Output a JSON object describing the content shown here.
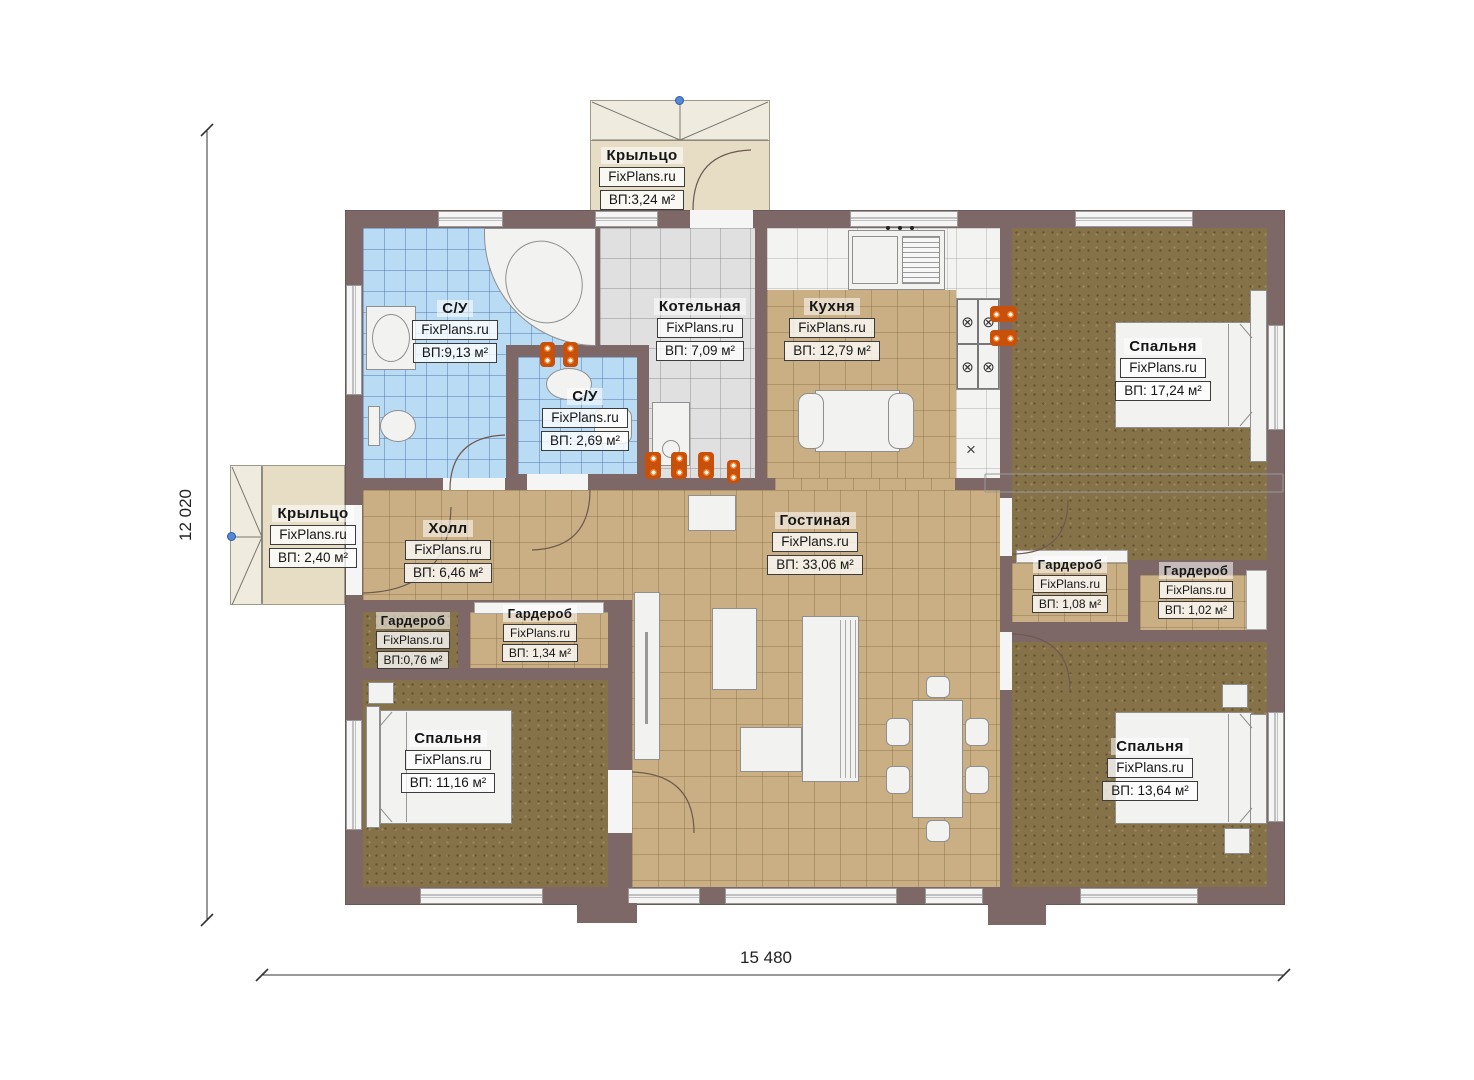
{
  "branding": {
    "watermark": "FixPlans.ru"
  },
  "dimensions": {
    "horizontal": "15 480",
    "vertical": "12 020"
  },
  "symbols": {
    "burner": "⊗",
    "cross": "×"
  },
  "colors": {
    "wall": "#7e6767",
    "floor_tan": "#c9af83",
    "floor_blue": "#badbf4",
    "floor_gray": "#e0e0e0",
    "floor_dark": "#867249",
    "porch": "#e7ddc5",
    "radiator": "#c7500a",
    "snap_dot": "#5588d8"
  },
  "rooms": [
    {
      "id": "porch-top",
      "name": "Крыльцо",
      "watermark": "FixPlans.ru",
      "area": "ВП:3,24 м²"
    },
    {
      "id": "bath-big",
      "name": "С/У",
      "watermark": "FixPlans.ru",
      "area": "ВП:9,13 м²"
    },
    {
      "id": "boiler",
      "name": "Котельная",
      "watermark": "FixPlans.ru",
      "area": "ВП: 7,09 м²"
    },
    {
      "id": "kitchen",
      "name": "Кухня",
      "watermark": "FixPlans.ru",
      "area": "ВП: 12,79 м²"
    },
    {
      "id": "bedroom-tr",
      "name": "Спальня",
      "watermark": "FixPlans.ru",
      "area": "ВП: 17,24 м²"
    },
    {
      "id": "bath-small",
      "name": "С/У",
      "watermark": "FixPlans.ru",
      "area": "ВП: 2,69 м²"
    },
    {
      "id": "porch-left",
      "name": "Крыльцо",
      "watermark": "FixPlans.ru",
      "area": "ВП: 2,40 м²"
    },
    {
      "id": "hall",
      "name": "Холл",
      "watermark": "FixPlans.ru",
      "area": "ВП: 6,46 м²"
    },
    {
      "id": "living",
      "name": "Гостиная",
      "watermark": "FixPlans.ru",
      "area": "ВП: 33,06 м²"
    },
    {
      "id": "ward-108",
      "name": "Гардероб",
      "watermark": "FixPlans.ru",
      "area": "ВП: 1,08 м²"
    },
    {
      "id": "ward-102",
      "name": "Гардероб",
      "watermark": "FixPlans.ru",
      "area": "ВП: 1,02 м²"
    },
    {
      "id": "ward-076",
      "name": "Гардероб",
      "watermark": "FixPlans.ru",
      "area": "ВП:0,76 м²"
    },
    {
      "id": "ward-134",
      "name": "Гардероб",
      "watermark": "FixPlans.ru",
      "area": "ВП: 1,34 м²"
    },
    {
      "id": "bedroom-bl",
      "name": "Спальня",
      "watermark": "FixPlans.ru",
      "area": "ВП: 11,16 м²"
    },
    {
      "id": "bedroom-br",
      "name": "Спальня",
      "watermark": "FixPlans.ru",
      "area": "ВП: 13,64 м²"
    }
  ]
}
